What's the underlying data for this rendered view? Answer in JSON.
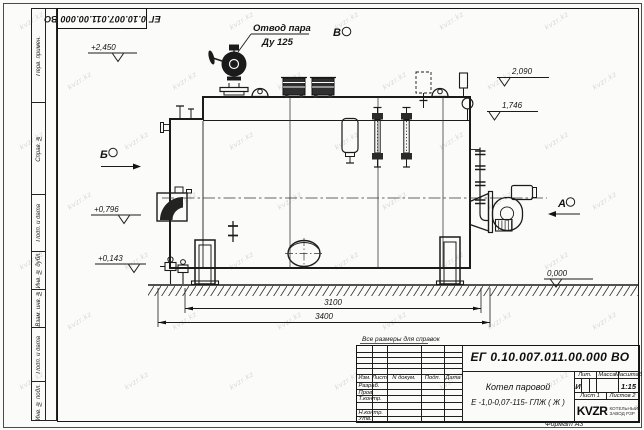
{
  "page": {
    "bg": "#fbfbf9",
    "line_color": "#1b1b1b",
    "watermark": "kvzr.kz"
  },
  "stamp_top": {
    "doc_number": "ЕГ 0.10.007.011.00.000  ВО"
  },
  "frame_labels": {
    "items": [
      "Перв. примен.",
      "Справ. №",
      "Подп. и дата",
      "Инв. № дубл.",
      "Взам. инв. №",
      "Подп. и дата",
      "Инв. № подл."
    ],
    "format": "Формат А3"
  },
  "annotations": {
    "callout_line1": "Отвод пара",
    "callout_line2": "Ду 125",
    "view_b": "Б",
    "view_v": "В",
    "view_a": "А",
    "level_2450": "+2,450",
    "level_2090": "2,090",
    "level_1746": "1,746",
    "level_0796": "+0,796",
    "level_0143": "+0,143",
    "level_0000": "0,000",
    "dim_inner": "3100",
    "dim_outer": "3400",
    "note": "Все размеры для справок"
  },
  "title_block": {
    "doc_number": "ЕГ 0.10.007.011.00.000  ВО",
    "product_line1": "Котел паровой",
    "product_line2": "Е -1,0-0,07-115- ГЛЖ ( Ж )",
    "headers": {
      "izm": "Изм.",
      "list": "Лист",
      "doc": "N докум.",
      "podp": "Подп.",
      "data": "Дата",
      "lit": "Лит.",
      "massa": "Масса",
      "scale": "Масштаб"
    },
    "rows": [
      "Разраб.",
      "Пров.",
      "Т.контр.",
      "",
      "Н.контр.",
      "Утв."
    ],
    "lit_value": "И",
    "scale_value": "1:15",
    "sheet": "Лист 1",
    "sheets": "Листов 2",
    "logo_text": "KVZR",
    "logo_sub_line1": "КОТЕЛЬНЫЙ",
    "logo_sub_line2": "ЗАВОД РЗР"
  }
}
